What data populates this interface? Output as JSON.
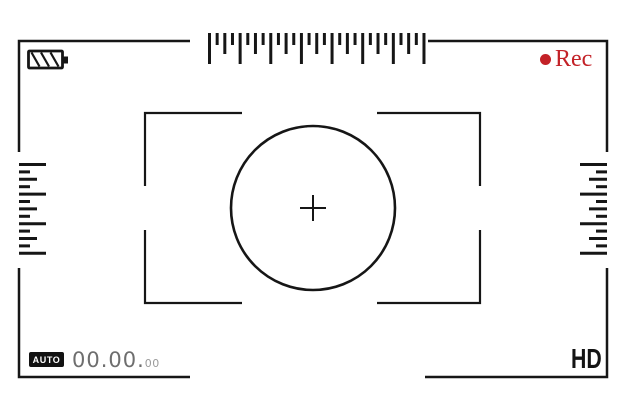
{
  "colors": {
    "ink": "#161616",
    "rec_red": "#c32127",
    "timecode_main": "#6e6e6e",
    "timecode_frames": "#9b9b9b"
  },
  "status_bar": {
    "rec_label": "Rec",
    "battery_icon": "battery-striped",
    "record_icon": "record-dot"
  },
  "bottom_bar": {
    "mode_label": "AUTO",
    "timecode_main": "00.00.",
    "timecode_frames": "00",
    "quality_label": "HD"
  },
  "rulers": {
    "top": {
      "orientation": "vertical-ticks",
      "anchor": "top",
      "x": 209.5,
      "y": 33,
      "spacing": 7.66,
      "count": 29,
      "thickness": 3,
      "pattern": [
        "long",
        "short",
        "medium",
        "short"
      ],
      "lengths": {
        "long": 31,
        "medium": 21,
        "short": 12
      }
    },
    "left": {
      "orientation": "horizontal-ticks",
      "anchor": "left",
      "x": 19,
      "y": 164.5,
      "spacing": 7.4,
      "count": 13,
      "thickness": 3,
      "pattern": [
        "long",
        "short",
        "medium",
        "short"
      ],
      "lengths": {
        "long": 27,
        "medium": 18,
        "short": 11
      }
    },
    "right": {
      "orientation": "horizontal-ticks",
      "anchor": "right",
      "x": 607,
      "y": 164.5,
      "spacing": 7.4,
      "count": 13,
      "thickness": 3,
      "pattern": [
        "long",
        "short",
        "medium",
        "short"
      ],
      "lengths": {
        "long": 27,
        "medium": 18,
        "short": 11
      }
    }
  }
}
